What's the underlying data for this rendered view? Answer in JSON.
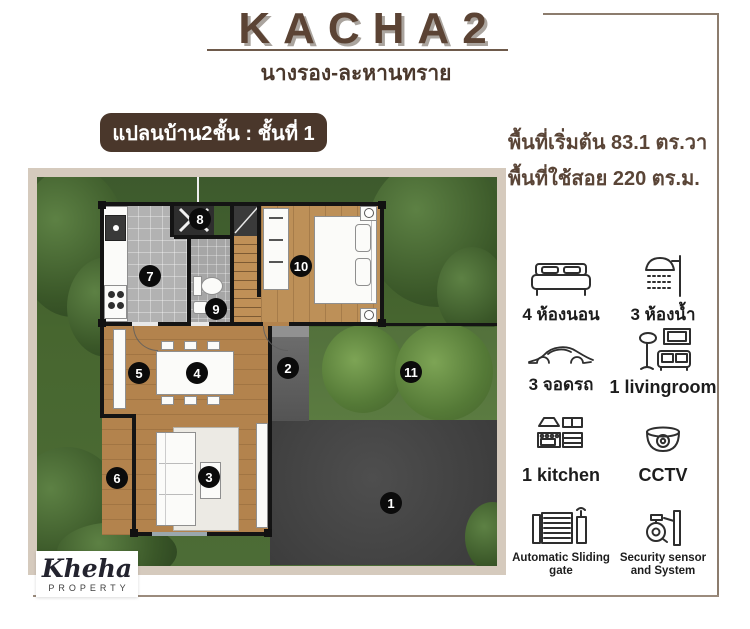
{
  "header": {
    "title": "KACHA2",
    "subtitle": "นางรอง-ละหานทราย",
    "plan_badge": "แปลนบ้าน2ชั้น : ชั้นที่ 1",
    "area_line1": "พื้นที่เริ่มต้น 83.1 ตร.วา",
    "area_line2": "พื้นที่ใช้สอย 220 ตร.ม."
  },
  "plan": {
    "markers": [
      "1",
      "2",
      "3",
      "4",
      "5",
      "6",
      "7",
      "8",
      "9",
      "10",
      "11"
    ]
  },
  "features": [
    {
      "icon": "bed-icon",
      "label": "4 ห้องนอน"
    },
    {
      "icon": "shower-icon",
      "label": "3 ห้องน้ำ"
    },
    {
      "icon": "car-icon",
      "label": "3 จอดรถ"
    },
    {
      "icon": "livingroom-icon",
      "label": "1 livingroom"
    },
    {
      "icon": "kitchen-icon",
      "label": "1 kitchen"
    },
    {
      "icon": "cctv-icon",
      "label": "CCTV"
    },
    {
      "icon": "gate-icon",
      "label": "Automatic Sliding gate"
    },
    {
      "icon": "security-icon",
      "label": "Security sensor and System"
    }
  ],
  "logo": {
    "name": "Kheha",
    "tagline": "PROPERTY"
  },
  "colors": {
    "title_brown": "#5b4334",
    "badge_brown": "#4a372b",
    "frame_line": "#8c7c6d",
    "photo_border": "#d5cabd",
    "marker_bg": "#0b0b0b"
  }
}
